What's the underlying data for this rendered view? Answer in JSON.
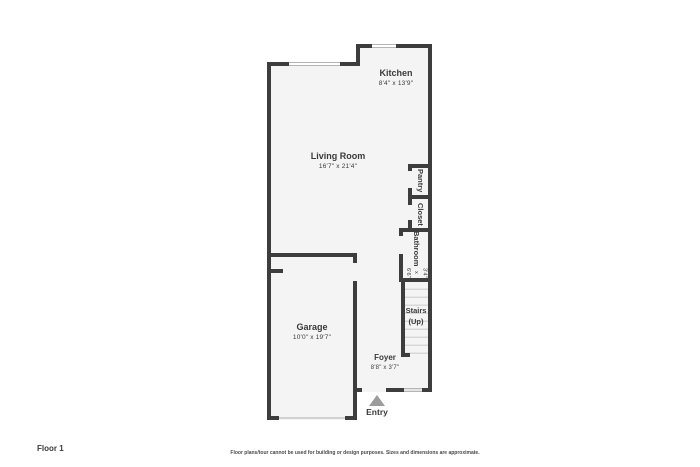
{
  "page": {
    "floor_label": "Floor 1",
    "disclaimer": "Floor plans/tour cannot be used for building or design purposes. Sizes and dimensions are approximate."
  },
  "rooms": {
    "kitchen": {
      "name": "Kitchen",
      "dims": "8'4\" x 13'9\""
    },
    "living_room": {
      "name": "Living Room",
      "dims": "16'7\" x 21'4\""
    },
    "garage": {
      "name": "Garage",
      "dims": "10'0\" x 19'7\""
    },
    "foyer": {
      "name": "Foyer",
      "dims": "8'8\" x 3'7\""
    },
    "bathroom": {
      "name": "Bathroom",
      "dims": "3'4\" x 6'6\""
    },
    "pantry": {
      "name": "Pantry"
    },
    "closet": {
      "name": "Closet"
    },
    "stairs": {
      "name": "Stairs",
      "direction": "(Up)"
    }
  },
  "entry": {
    "label": "Entry"
  },
  "colors": {
    "wall": "#3d3d3d",
    "floor": "#f4f4f4",
    "background": "#ffffff",
    "text": "#3a3a3a",
    "entry_arrow": "#9c9c9c",
    "stair_tread": "#d8d8d8"
  }
}
